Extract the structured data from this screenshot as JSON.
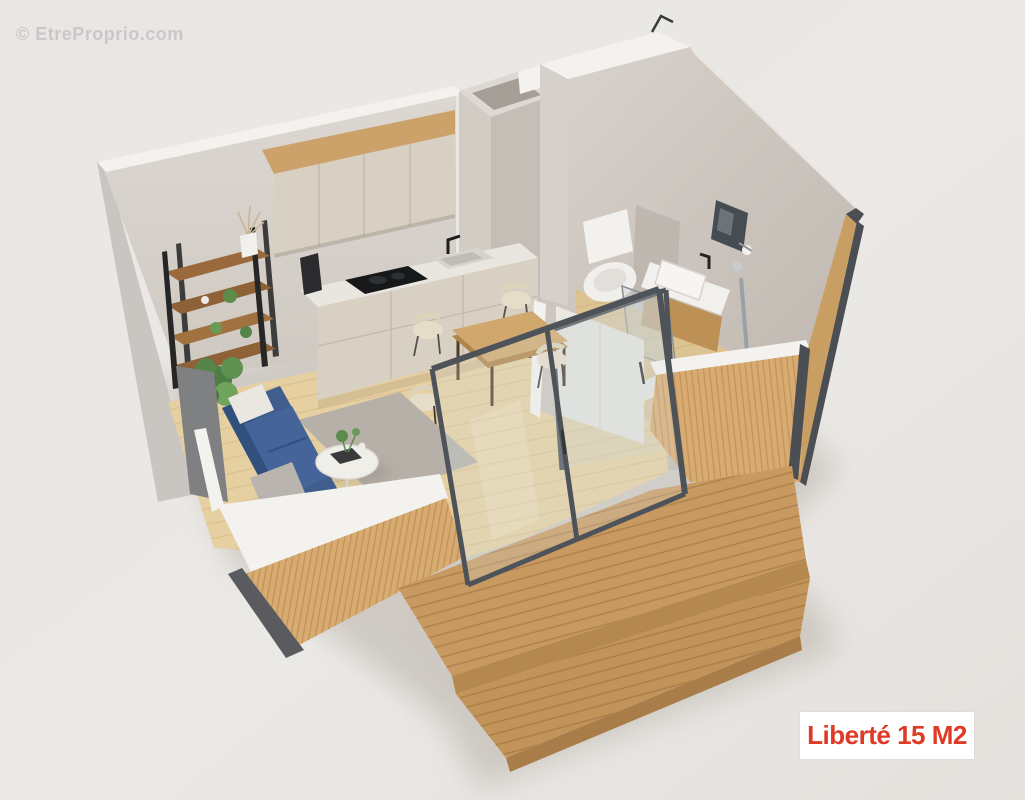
{
  "watermark": {
    "text": "© EtreProprio.com"
  },
  "badge": {
    "label": "Liberté 15 M2"
  },
  "colors": {
    "background": "#eae7e4",
    "concrete_wall": "#d6d0ca",
    "concrete_wall_shaded": "#c3bbb3",
    "wall_top_edge": "#f4f2ef",
    "corner_trim": "#4b4e52",
    "wood_cladding": "#d8ab71",
    "deck_wood": "#c89a61",
    "interior_floor": "#e6d0a2",
    "kitchen_cabinet": "#d8d0c3",
    "wood_accent": "#cda26a",
    "sofa_blue": "#3f5e8e",
    "rug_gray": "#b6b0a8",
    "hob_black": "#17181a",
    "glass_frame": "#4e5359",
    "badge_bg": "#ffffff",
    "badge_text": "#df3a26"
  },
  "scene": {
    "alt": "3D isometric cutaway rendering of a 15 m2 studio tiny-house with kitchen, living area, dining table, bathroom and wooden front deck"
  }
}
